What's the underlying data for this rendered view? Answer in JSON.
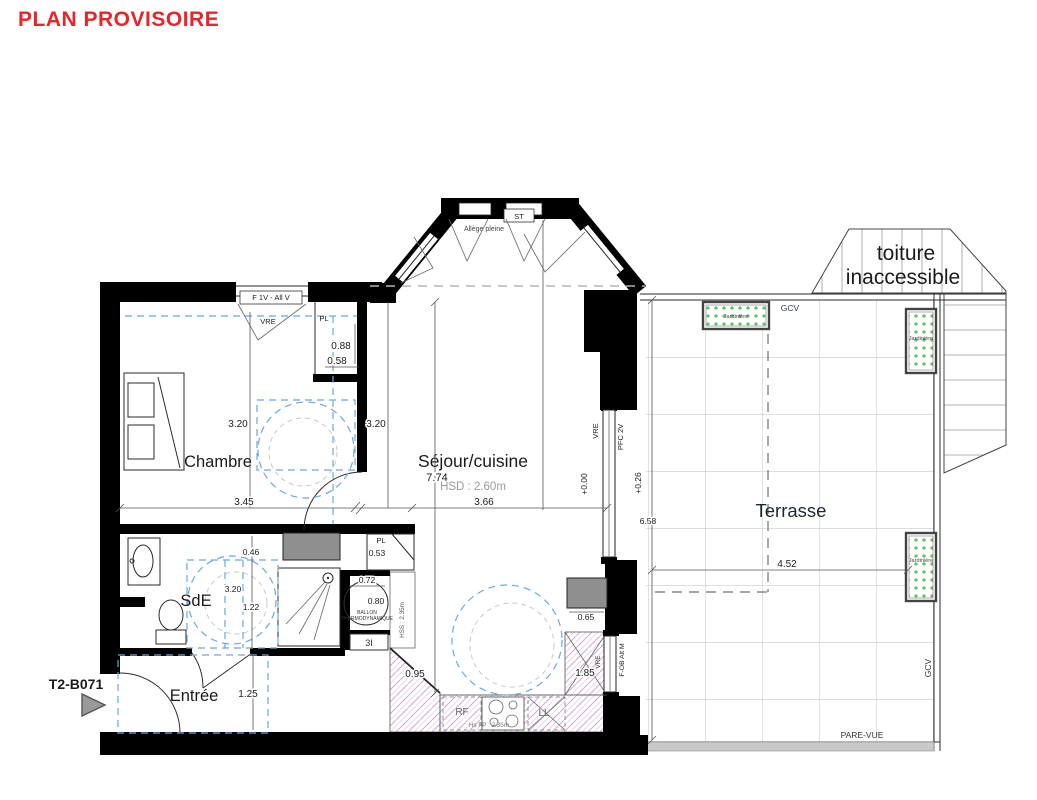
{
  "title": {
    "text": "PLAN PROVISOIRE"
  },
  "unit": {
    "code": "T2-B071"
  },
  "rooms": {
    "chambre": "Chambre",
    "sejour": "Séjour/cuisine",
    "hsd": "HSD : 2.60m",
    "sde": "SdE",
    "entree": "Entrée",
    "terrasse": "Terrasse",
    "toiture_line1": "toiture",
    "toiture_line2": "inaccessible"
  },
  "labels": {
    "f1v": "F 1V - All V",
    "vre": "VRE",
    "pl": "PL",
    "st": "ST",
    "allege": "Allège pleine",
    "pfc": "PFC 2V",
    "fob": "F-OB Alt M",
    "gcv": "GCV",
    "jardiniere": "Jardinière",
    "pare_vue": "PARE-VUE",
    "ballon1": "BALLON",
    "ballon2": "THERMODYNAMIQUE",
    "hss": "HSS : 2.35m",
    "hsfp": "Hs FP : 2.35m",
    "rf": "RF",
    "ll": "LL",
    "tag_3i": "3I"
  },
  "levels": {
    "zero": "+0.00",
    "terrace": "+0.26"
  },
  "dims": {
    "d088": "0.88",
    "d058": "0.58",
    "d320a": "3.20",
    "d320b": "3.20",
    "d320c": "3.20",
    "d345": "3.45",
    "d366": "3.66",
    "d774": "7.74",
    "d046": "0.46",
    "d122": "1.22",
    "d053": "0.53",
    "d072": "0.72",
    "d080": "0.80",
    "d065": "0.65",
    "d185": "1.85",
    "d095": "0.95",
    "d125": "1.25",
    "d658": "6.58",
    "d452": "4.52"
  },
  "colors": {
    "title_red": "#e8252a",
    "blue_dash": "#6fa8dc",
    "hatch_pink": "#d6a6d6",
    "planter_green": "#3aa83f",
    "duct_gray": "#8f8f8f",
    "wall_black": "#000000"
  }
}
